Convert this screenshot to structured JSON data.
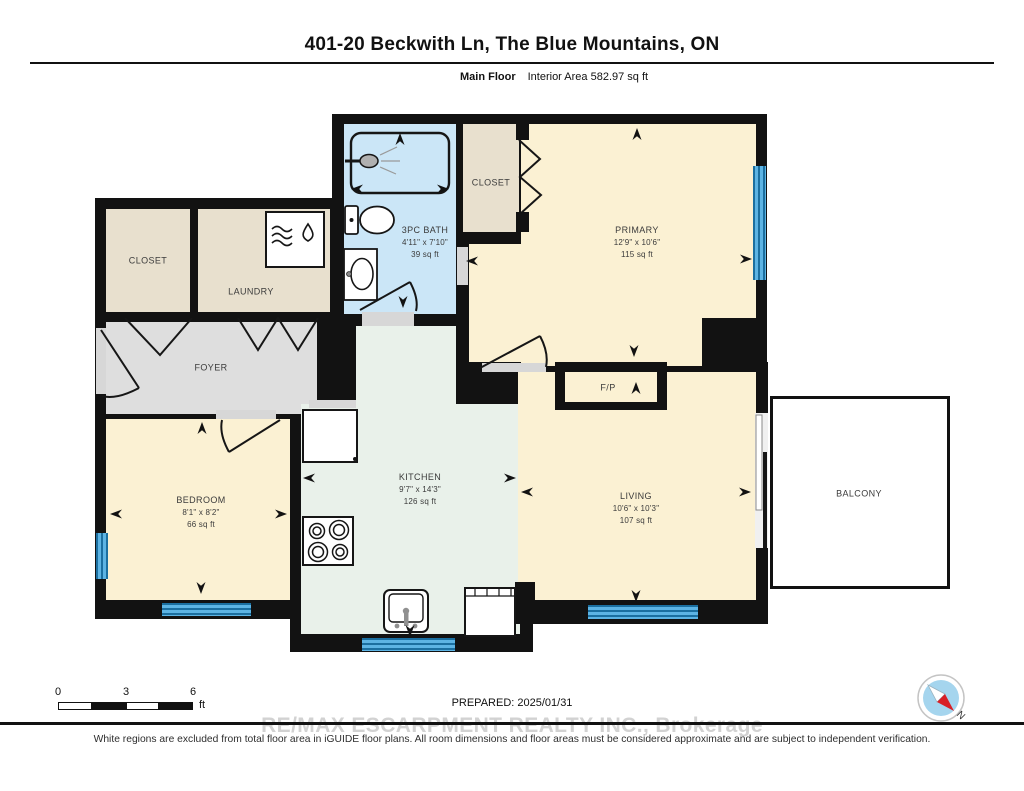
{
  "header": {
    "title": "401-20 Beckwith Ln, The Blue Mountains, ON",
    "floor_label": "Main Floor",
    "area_label": "Interior Area 582.97 sq ft"
  },
  "rooms": {
    "closet1": {
      "name": "CLOSET"
    },
    "laundry": {
      "name": "LAUNDRY"
    },
    "bath": {
      "name": "3PC BATH",
      "dims": "4'11\" x 7'10\"",
      "area": "39 sq ft"
    },
    "closet2": {
      "name": "CLOSET"
    },
    "primary": {
      "name": "PRIMARY",
      "dims": "12'9\" x 10'6\"",
      "area": "115 sq ft"
    },
    "foyer": {
      "name": "FOYER"
    },
    "bedroom": {
      "name": "BEDROOM",
      "dims": "8'1\" x 8'2\"",
      "area": "66 sq ft"
    },
    "kitchen": {
      "name": "KITCHEN",
      "dims": "9'7\" x 14'3\"",
      "area": "126 sq ft"
    },
    "living": {
      "name": "LIVING",
      "dims": "10'6\" x 10'3\"",
      "area": "107 sq ft"
    },
    "fireplace": {
      "name": "F/P"
    },
    "balcony": {
      "name": "BALCONY"
    }
  },
  "fixtures": [
    "shower",
    "toilet",
    "bath-sink",
    "washer-dryer",
    "fridge",
    "stove",
    "kitchen-sink",
    "dishwasher"
  ],
  "scale_bar": {
    "t0": "0",
    "t3": "3",
    "t6": "6",
    "unit": "ft"
  },
  "footer": {
    "prepared": "PREPARED: 2025/01/31",
    "watermark": "RE/MAX ESCARPMENT REALTY INC., Brokerage",
    "disclaimer": "White regions are excluded from total floor area in iGUIDE floor plans. All room dimensions and floor areas must be considered approximate and are subject to independent verification."
  },
  "compass": {
    "label": "N"
  },
  "colors": {
    "wall": "#121212",
    "room_cream": "#fbf1d3",
    "room_tan": "#e8e0ce",
    "room_gray": "#dedede",
    "room_green": "#e9f1ea",
    "bath_blue": "#cbe6f7",
    "window_blue": "#5db4e4",
    "compass_red": "#d81f26"
  }
}
